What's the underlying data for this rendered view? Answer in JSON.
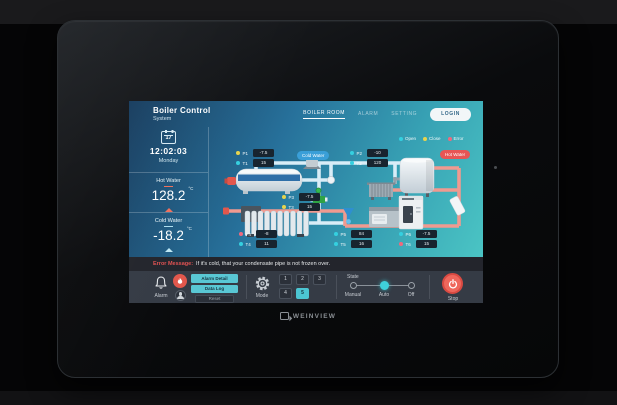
{
  "brand": {
    "name": "WEINVIEW"
  },
  "header": {
    "title": "Boiler Control",
    "subtitle": "System",
    "nav": [
      {
        "label": "BOILER ROOM",
        "active": true
      },
      {
        "label": "ALARM",
        "active": false
      },
      {
        "label": "SETTING",
        "active": false
      }
    ],
    "login_label": "LOGIN"
  },
  "sidebar": {
    "date_day": "17",
    "time": "12:02:03",
    "weekday": "Monday",
    "hot": {
      "label": "Hot Water",
      "value": "128.2",
      "unit": "°C"
    },
    "cold": {
      "label": "Cold Water",
      "value": "-18.2",
      "unit": "°C"
    }
  },
  "legend": {
    "items": [
      {
        "label": "Open",
        "color": "#35d0e0"
      },
      {
        "label": "Close",
        "color": "#e8d44d"
      },
      {
        "label": "Error",
        "color": "#f0697e"
      }
    ]
  },
  "diagram": {
    "cold_tag": "Cold Water",
    "hot_tag": "Hot Water",
    "sensors": [
      {
        "label": "P1",
        "value": "-7.5",
        "status": "close"
      },
      {
        "label": "T1",
        "value": "15",
        "status": "open"
      },
      {
        "label": "P2",
        "value": "-10",
        "status": "open"
      },
      {
        "label": "T2",
        "value": "120",
        "status": "open"
      },
      {
        "label": "P3",
        "value": "-7.5",
        "status": "close"
      },
      {
        "label": "T3",
        "value": "15",
        "status": "close"
      },
      {
        "label": "P4",
        "value": "-8",
        "status": "error"
      },
      {
        "label": "T4",
        "value": "11",
        "status": "open"
      },
      {
        "label": "P5",
        "value": "84",
        "status": "open"
      },
      {
        "label": "T5",
        "value": "16",
        "status": "open"
      },
      {
        "label": "P6",
        "value": "-7.5",
        "status": "open"
      },
      {
        "label": "T6",
        "value": "15",
        "status": "error"
      }
    ]
  },
  "error_bar": {
    "label": "Error Message:",
    "message": "If it's cold, that your condensate pipe is not frozen over."
  },
  "controls": {
    "alarm": {
      "label": "Alarm",
      "buttons": [
        "Alarm Detail",
        "Data Log",
        "Reset"
      ]
    },
    "mode": {
      "label": "Mode",
      "numbers": [
        "1",
        "2",
        "3",
        "4",
        "5"
      ],
      "selected": "5"
    },
    "state": {
      "label": "State",
      "options": [
        "Manual",
        "Auto",
        "Off"
      ],
      "selected": "Auto"
    },
    "stop": {
      "label": "Stop"
    }
  },
  "colors": {
    "open": "#35d0e0",
    "close": "#e8d44d",
    "error": "#f0697e",
    "accent": "#4cc5d2",
    "stop_red": "#ef675c",
    "hot_pipe": "#f09a90",
    "cold_pipe": "#d9edf7"
  }
}
